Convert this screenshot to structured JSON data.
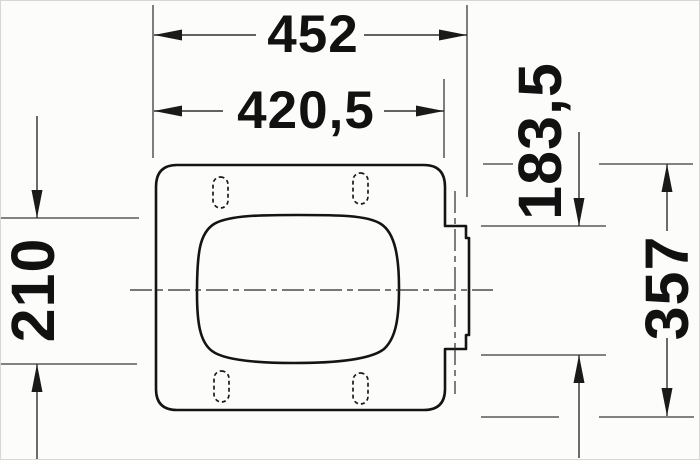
{
  "dimensions": {
    "overall_width": "452",
    "seat_body_width": "420,5",
    "hinge_plate_height": "183,5",
    "opening_height": "210",
    "overall_depth": "357"
  },
  "colors": {
    "ink": "#141414",
    "dimension_ink": "#2e2e2e",
    "background": "#fcfcfa"
  }
}
